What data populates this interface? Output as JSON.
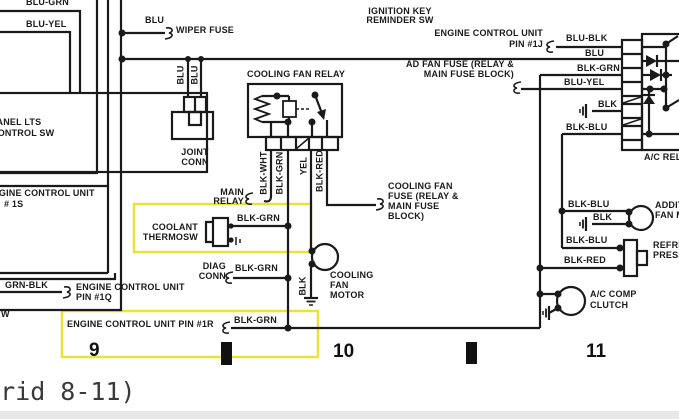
{
  "colors": {
    "line": "#1a1a1a",
    "highlight": "#e9e23b",
    "background": "#ffffff"
  },
  "caption": "(Grid 8-11)",
  "grid": {
    "g9": "9",
    "g10": "10",
    "g11": "11"
  },
  "labels": {
    "blu_grn": "BLU-GRN",
    "blu_yel": "BLU-YEL",
    "panel_1": "PANEL LTS",
    "panel_2": "CONTROL SW",
    "ecu1s_1": "ENGINE CONTROL UNIT",
    "ecu1s_2": "# 1S",
    "grn_blk": "GRN-BLK",
    "ecu1q_1": "ENGINE CONTROL UNIT",
    "ecu1q_2": "PIN #1Q",
    "w_frag": "W",
    "blu_wiper": "BLU",
    "wiper_fuse": "WIPER FUSE",
    "ignition_1": "IGNITION KEY",
    "ignition_2": "REMINDER SW",
    "joint_1": "JOINT",
    "joint_2": "CONN",
    "blu_a": "BLU",
    "blu_b": "BLU",
    "cooling_fan_relay": "COOLING FAN RELAY",
    "blk_wht": "BLK-WHT",
    "blk_grn_v": "BLK-GRN",
    "yel": "YEL",
    "blk_red_v": "BLK-RED",
    "main_1": "MAIN",
    "main_2": "RELAY",
    "fuse_1": "COOLING FAN",
    "fuse_2": "FUSE (RELAY &",
    "fuse_3": "MAIN FUSE",
    "fuse_4": "BLOCK)",
    "coolant_1": "COOLANT",
    "coolant_2": "THERMOSW",
    "blk_grn_t": "BLK-GRN",
    "diag_1": "DIAG",
    "diag_2": "CONN",
    "blk_grn_d": "BLK-GRN",
    "ecu1r": "ENGINE CONTROL UNIT PIN #1R",
    "blk_grn_r": "BLK-GRN",
    "motor_1": "COOLING",
    "motor_2": "FAN",
    "motor_3": "MOTOR",
    "blk_motor": "BLK",
    "ecu1j_1": "ENGINE CONTROL UNIT",
    "ecu1j_2": "PIN #1J",
    "adfan_1": "AD FAN FUSE (RELAY &",
    "adfan_2": "MAIN FUSE BLOCK)",
    "blu_blk": "BLU-BLK",
    "blu_r": "BLU",
    "blk_grn_ac": "BLK-GRN",
    "blu_yel_ac": "BLU-YEL",
    "blk_ac": "BLK",
    "blk_blu_ac": "BLK-BLU",
    "ac_relay": "A/C RELAY",
    "blk_blu_fan": "BLK-BLU",
    "blk_fan": "BLK",
    "addfan_1": "ADDITIONAL",
    "addfan_2": "FAN MOTOR",
    "blk_blu_p": "BLK-BLU",
    "blk_red_p": "BLK-RED",
    "refr_1": "REFRIGERANT",
    "refr_2": "PRESSURE SW",
    "clutch_1": "A/C COMP",
    "clutch_2": "CLUTCH"
  }
}
